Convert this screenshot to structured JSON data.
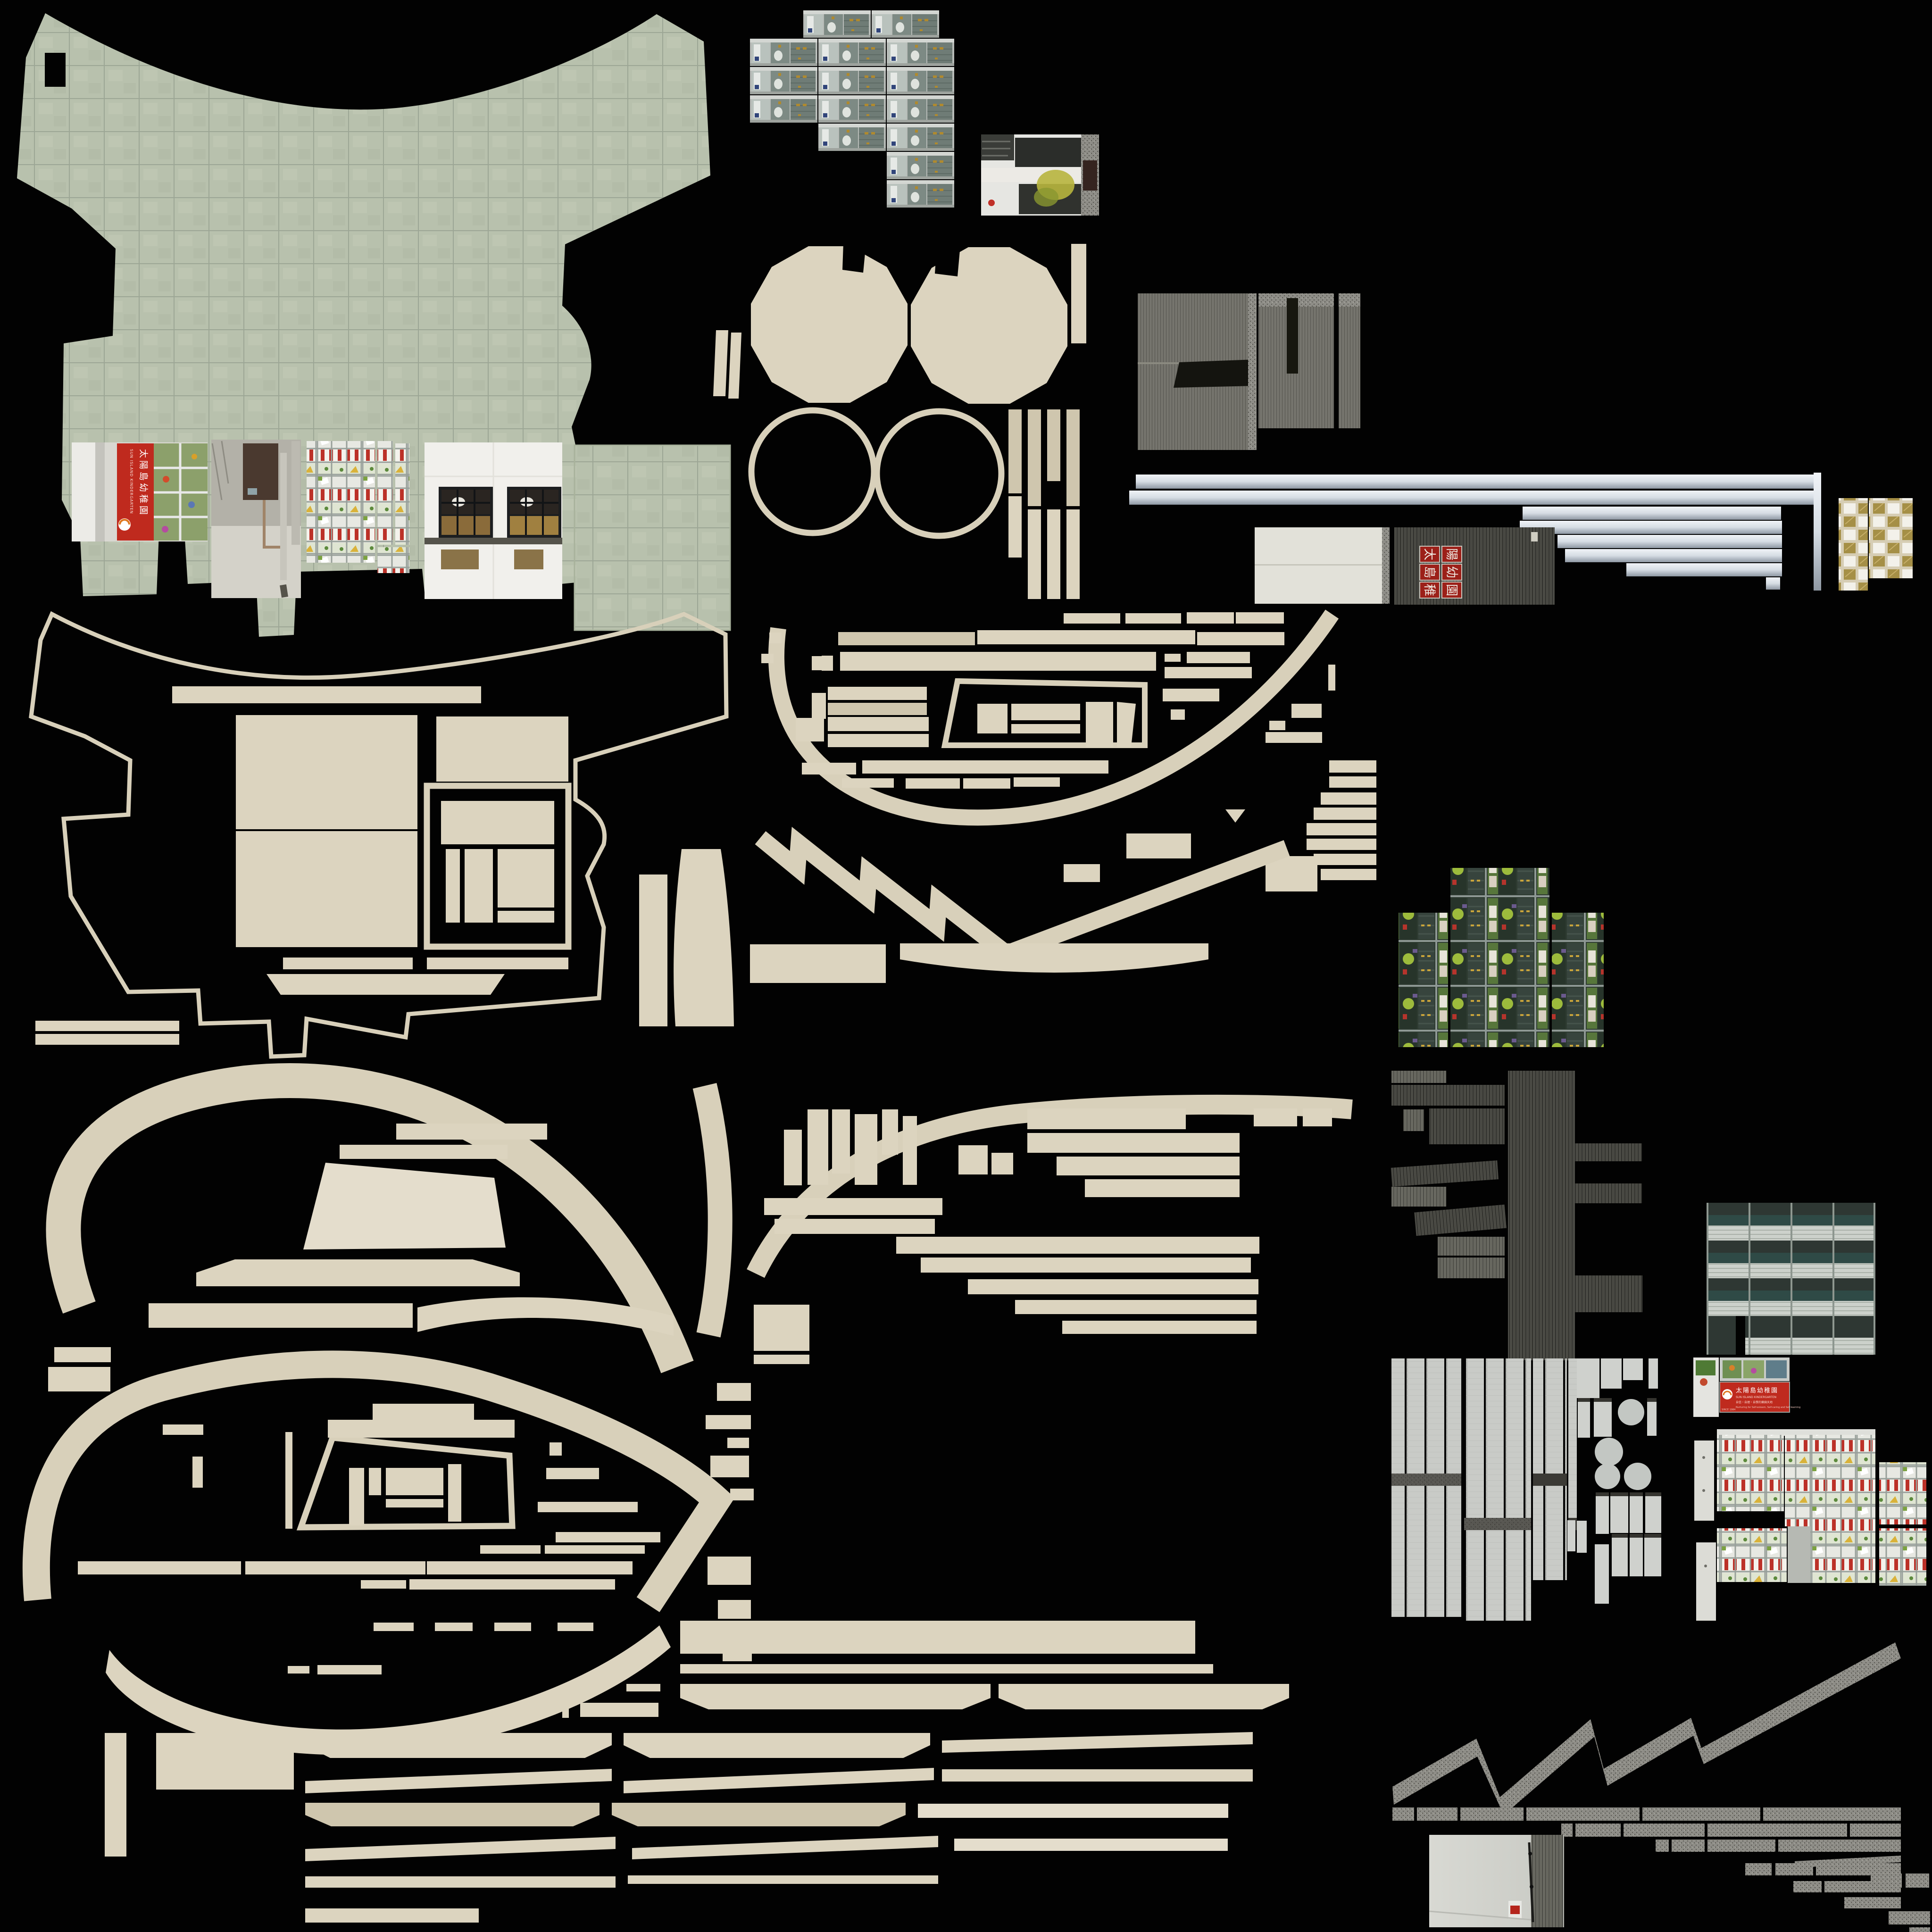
{
  "signs": {
    "kindergarten": {
      "name_zh": "太陽島幼稚園",
      "name_en": "SUN ISLAND KINDERGARTEN",
      "tagline_zh": "自信・自理・自學的樂園天地",
      "tagline_en": "Nurturing for Self-esteem, Self-caring and Self-learning",
      "since": "SINCE 1984"
    },
    "red_wall_characters": [
      "太",
      "陽",
      "島",
      "幼",
      "稚",
      "園"
    ]
  },
  "palette": {
    "background": "#020202",
    "parchment": "#dcd4bf",
    "parchment_dark": "#cfc6ae",
    "parchment_light": "#e4ddcc",
    "outline": "#d8d0ba",
    "tile_green": "#b8c1ad",
    "tile_green_line": "#9ca695",
    "sign_red": "#bf2a1e",
    "red_tile": "#9c2019",
    "metal_beam_light": "#f0f3f7",
    "metal_beam_dark": "#8f98a3",
    "concrete": "#75746d",
    "shutter_dark": "#50504a",
    "shutter_light": "#6e6e66",
    "plank_gray": "#c9cbc7",
    "speckle_gray": "#8e8d87",
    "glass_dark": "#2e3733",
    "glass_teal": "#2f4a46",
    "facade_band": "#ccd1cb",
    "window_gold": "#a58f46",
    "window_white": "#f3f1ea"
  }
}
